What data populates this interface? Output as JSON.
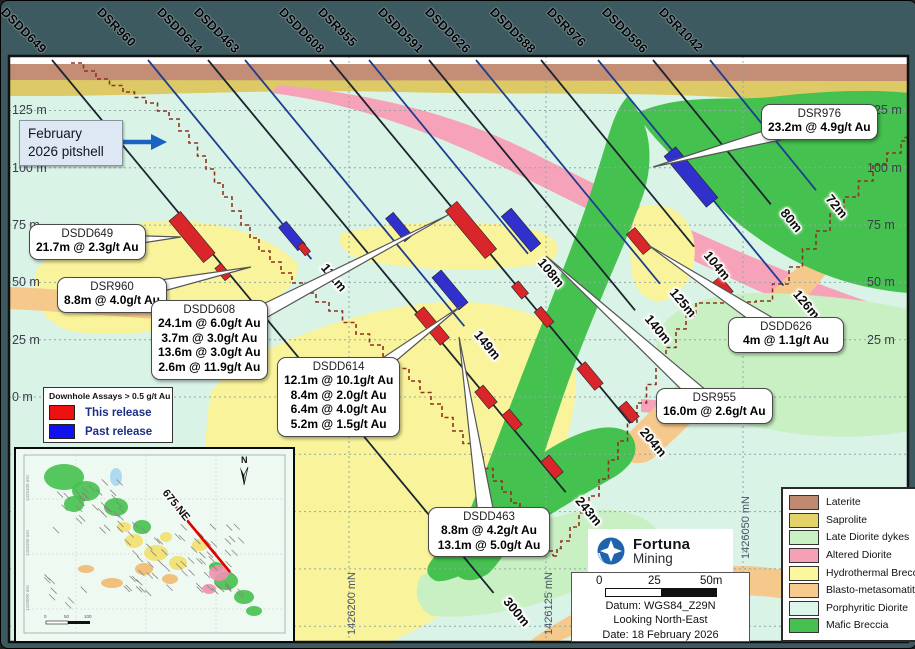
{
  "figure": {
    "pitshell_label_1": "February",
    "pitshell_label_2": "2026 pitshell",
    "logo": {
      "name": "Fortuna",
      "sub": "Mining"
    },
    "scalebar": {
      "t0": "0",
      "t25": "25",
      "t50": "50m"
    },
    "info": {
      "datum": "Datum: WGS84_Z29N",
      "looking": "Looking North-East",
      "date": "Date: 18 February 2026"
    },
    "inset": {
      "section_label": "675 NE",
      "north_label": "N",
      "axis_labels": [
        "1426400 mN",
        "1426200 mN",
        "1426000 mN"
      ]
    }
  },
  "axes": {
    "elev_left": [
      {
        "label": "125 m",
        "y": 109
      },
      {
        "label": "100 m",
        "y": 167
      },
      {
        "label": "75 m",
        "y": 224
      },
      {
        "label": "50 m",
        "y": 281
      },
      {
        "label": "25 m",
        "y": 339
      },
      {
        "label": "0 m",
        "y": 396
      }
    ],
    "elev_right": [
      {
        "label": "125 m",
        "y": 109
      },
      {
        "label": "100 m",
        "y": 167
      },
      {
        "label": "75 m",
        "y": 224
      },
      {
        "label": "50 m",
        "y": 281
      },
      {
        "label": "25 m",
        "y": 339
      }
    ],
    "grid_y": [
      109.5,
      166.8,
      224.1,
      281.4,
      338.7,
      396,
      453.3,
      510.6,
      567.9,
      625.2
    ],
    "northings": [
      {
        "label": "1426200 mN",
        "x": 348
      },
      {
        "label": "1426125 mN",
        "x": 545,
        "ytop": 560
      },
      {
        "label": "1426050 mN",
        "x": 742,
        "yb": 558
      }
    ]
  },
  "holes": [
    {
      "name": "DSDD649",
      "collar": 51,
      "depth": 300,
      "depth_label": "300m"
    },
    {
      "name": "DSR960",
      "collar": 147,
      "depth": 111,
      "depth_label": "111m"
    },
    {
      "name": "DSDD614",
      "collar": 207,
      "depth": 243,
      "depth_label": "243m"
    },
    {
      "name": "DSDD463",
      "collar": 244,
      "depth": 149,
      "depth_label": "149m"
    },
    {
      "name": "DSDD608",
      "collar": 329,
      "depth": 204,
      "depth_label": "204m"
    },
    {
      "name": "DSR955",
      "collar": 368,
      "depth": 108,
      "depth_label": "108m"
    },
    {
      "name": "DSDD591",
      "collar": 428,
      "depth": 140,
      "depth_label": "140m"
    },
    {
      "name": "DSDD626",
      "collar": 475,
      "depth": 125,
      "depth_label": "125m"
    },
    {
      "name": "DSDD588",
      "collar": 540,
      "depth": 104,
      "depth_label": "104m"
    },
    {
      "name": "DSR976",
      "collar": 597,
      "depth": 126,
      "depth_label": "126m"
    },
    {
      "name": "DSDD596",
      "collar": 652,
      "depth": 80,
      "depth_label": "80m"
    },
    {
      "name": "DSR1042",
      "collar": 709,
      "depth": 72,
      "depth_label": "72m"
    }
  ],
  "intervals": [
    {
      "x": 191,
      "y": 236,
      "len": 54,
      "w": 15,
      "c": "this"
    },
    {
      "x": 222,
      "y": 271,
      "len": 16,
      "w": 8,
      "c": "this"
    },
    {
      "x": 291,
      "y": 235,
      "len": 30,
      "w": 10,
      "c": "past"
    },
    {
      "x": 303,
      "y": 248,
      "len": 12,
      "w": 7,
      "c": "this"
    },
    {
      "x": 398,
      "y": 226,
      "len": 30,
      "w": 10,
      "c": "past"
    },
    {
      "x": 470,
      "y": 229,
      "len": 62,
      "w": 15,
      "c": "this"
    },
    {
      "x": 520,
      "y": 229,
      "len": 46,
      "w": 13,
      "c": "past"
    },
    {
      "x": 449,
      "y": 289,
      "len": 42,
      "w": 12,
      "c": "past"
    },
    {
      "x": 431,
      "y": 325,
      "len": 40,
      "w": 12,
      "c": "this"
    },
    {
      "x": 519,
      "y": 289,
      "len": 16,
      "w": 9,
      "c": "this"
    },
    {
      "x": 543,
      "y": 316,
      "len": 20,
      "w": 9,
      "c": "this"
    },
    {
      "x": 589,
      "y": 375,
      "len": 28,
      "w": 11,
      "c": "this"
    },
    {
      "x": 628,
      "y": 411,
      "len": 20,
      "w": 10,
      "c": "this"
    },
    {
      "x": 485,
      "y": 396,
      "len": 22,
      "w": 11,
      "c": "this"
    },
    {
      "x": 511,
      "y": 419,
      "len": 20,
      "w": 10,
      "c": "this"
    },
    {
      "x": 551,
      "y": 466,
      "len": 22,
      "w": 11,
      "c": "this"
    },
    {
      "x": 638,
      "y": 240,
      "len": 26,
      "w": 11,
      "c": "this"
    },
    {
      "x": 690,
      "y": 176,
      "len": 66,
      "w": 15,
      "c": "past"
    },
    {
      "x": 722,
      "y": 286,
      "len": 20,
      "w": 10,
      "c": "this"
    }
  ],
  "callouts": [
    {
      "id": "dsdd649",
      "title": "DSDD649",
      "lines": [
        "21.7m @ 2.3g/t Au"
      ],
      "x": 28,
      "y": 223,
      "w": 110,
      "h": 38,
      "tip": [
        180,
        236
      ]
    },
    {
      "id": "dsr960",
      "title": "DSR960",
      "lines": [
        "8.8m @ 4.0g/t Au"
      ],
      "x": 56,
      "y": 276,
      "w": 110,
      "h": 38,
      "tip": [
        250,
        266
      ]
    },
    {
      "id": "dsdd608",
      "title": "DSDD608",
      "lines": [
        "24.1m @ 6.0g/t Au",
        "3.7m @ 3.0g/t Au",
        "13.6m @ 3.0g/t Au",
        "2.6m @ 11.9g/t Au"
      ],
      "x": 150,
      "y": 299,
      "w": 108,
      "h": 84,
      "tip": [
        447,
        214
      ]
    },
    {
      "id": "dsdd614",
      "title": "DSDD614",
      "lines": [
        "12.1m @ 10.1g/t Au",
        "8.4m @ 2.0g/t Au",
        "6.4m @ 4.0g/t Au",
        "5.2m @ 1.5g/t Au"
      ],
      "x": 276,
      "y": 356,
      "w": 120,
      "h": 84,
      "tip": [
        460,
        305
      ]
    },
    {
      "id": "dsdd463",
      "title": "DSDD463",
      "lines": [
        "8.8m @ 4.2g/t Au",
        "13.1m @ 5.0g/t Au"
      ],
      "x": 427,
      "y": 506,
      "w": 122,
      "h": 54,
      "tip": [
        458,
        336
      ]
    },
    {
      "id": "dsr976",
      "title": "DSR976",
      "lines": [
        "23.2m @ 4.9g/t Au"
      ],
      "x": 760,
      "y": 103,
      "w": 112,
      "h": 38,
      "tip": [
        652,
        166
      ]
    },
    {
      "id": "dsdd626",
      "title": "DSDD626",
      "lines": [
        "4m @ 1.1g/t Au"
      ],
      "x": 727,
      "y": 316,
      "w": 116,
      "h": 38,
      "tip": [
        647,
        244
      ]
    },
    {
      "id": "dsr955",
      "title": "DSR955",
      "lines": [
        "16.0m @ 2.6g/t Au"
      ],
      "x": 655,
      "y": 387,
      "w": 112,
      "h": 38,
      "tip": [
        545,
        255
      ]
    }
  ],
  "assay_legend": {
    "title": "Downhole Assays > 0.5 g/t Au",
    "items": [
      {
        "label": "This release",
        "color": "#ee1111"
      },
      {
        "label": "Past release",
        "color": "#1111ee"
      }
    ]
  },
  "geo_legend": [
    {
      "label": "Laterite",
      "color": "#c08a72"
    },
    {
      "label": "Saprolite",
      "color": "#e3d169"
    },
    {
      "label": "Late Diorite dykes",
      "color": "#c9f2c4"
    },
    {
      "label": "Altered Diorite",
      "color": "#f6a0b6"
    },
    {
      "label": "Hydrothermal Breccia",
      "color": "#fbf89c"
    },
    {
      "label": "Blasto-metasomatite",
      "color": "#f7ca8e"
    },
    {
      "label": "Porphyritic Diorite",
      "color": "#dcf6ec"
    },
    {
      "label": "Mafic Breccia",
      "color": "#44c14e"
    }
  ],
  "colors": {
    "surround": "#3e5a61",
    "section_bg": "#d9f3e7",
    "this_release": "#d8262b",
    "past_release": "#3030cc",
    "pitshell": "#8d3420",
    "grid": "#92a8a8",
    "trace_dark": "#1c2430",
    "trace_blue": "#1d3e8e",
    "arrow_blue": "#1b63c1"
  },
  "pitshell": {
    "left": [
      [
        70,
        62
      ],
      [
        95,
        78
      ],
      [
        122,
        91
      ],
      [
        145,
        102
      ],
      [
        168,
        118
      ],
      [
        188,
        142
      ],
      [
        205,
        168
      ],
      [
        222,
        196
      ],
      [
        240,
        224
      ],
      [
        258,
        250
      ],
      [
        280,
        272
      ],
      [
        302,
        292
      ],
      [
        328,
        310
      ],
      [
        355,
        333
      ],
      [
        382,
        355
      ],
      [
        408,
        380
      ],
      [
        430,
        403
      ],
      [
        452,
        430
      ],
      [
        472,
        455
      ],
      [
        492,
        480
      ],
      [
        510,
        502
      ],
      [
        528,
        524
      ],
      [
        542,
        545
      ],
      [
        552,
        555
      ]
    ],
    "right": [
      [
        552,
        555
      ],
      [
        560,
        540
      ],
      [
        578,
        512
      ],
      [
        598,
        478
      ],
      [
        617,
        440
      ],
      [
        636,
        402
      ],
      [
        655,
        365
      ],
      [
        675,
        328
      ],
      [
        695,
        302
      ],
      [
        755,
        300
      ],
      [
        788,
        266
      ],
      [
        815,
        230
      ],
      [
        843,
        196
      ],
      [
        872,
        164
      ],
      [
        900,
        140
      ],
      [
        907,
        133
      ]
    ]
  },
  "geology": [
    {
      "unit": "saprolite",
      "color": "#ddca66",
      "d": "M8,78 L907,78 L907,112 C840,110 780,98 700,95 C600,91 520,94 400,91 C280,88 160,94 60,95 L8,95 Z"
    },
    {
      "unit": "laterite",
      "color": "#c38d76",
      "d": "M8,62 L907,62 L907,80 L8,79 Z"
    },
    {
      "unit": "surface_cap",
      "color": "#ffffff",
      "d": "M8,55 L907,55 L907,63 L8,63 Z"
    },
    {
      "unit": "altered_diorite",
      "color": "#f6a3b9",
      "d": "M278,84 C360,92 440,108 520,146 C600,186 680,228 790,272 C840,292 880,305 907,315 L907,345 C860,330 800,310 740,282 C660,245 580,205 500,165 C420,126 340,100 270,92 Z"
    },
    {
      "unit": "altered_diorite",
      "color": "#f6a3b9",
      "d": "M640,398 C720,404 800,408 907,400 L907,412 C800,421 720,417 640,411 Z"
    },
    {
      "unit": "altered_diorite",
      "color": "#f6a3b9",
      "d": "M595,545 C630,538 672,548 702,563 C682,579 640,583 610,575 C595,568 588,555 595,545 Z"
    },
    {
      "unit": "hydrothermal_breccia",
      "color": "#f9f49b",
      "d": "M36,268 C60,238 110,222 160,220 C220,218 270,235 296,262 C300,285 275,300 240,312 C190,328 120,338 70,330 C40,322 28,295 36,268 Z"
    },
    {
      "unit": "hydrothermal_breccia",
      "color": "#f9f49b",
      "d": "M340,232 C400,220 470,216 530,228 C560,235 565,252 545,262 C490,272 420,270 365,260 C342,254 335,242 340,232 Z"
    },
    {
      "unit": "hydrothermal_breccia",
      "color": "#f9f49b",
      "d": "M210,390 C240,355 300,330 370,312 C440,295 500,298 540,318 C570,335 580,370 572,410 C565,455 545,505 515,545 C485,585 440,620 390,640 L240,640 C215,620 200,560 202,500 C203,460 205,420 210,390 Z"
    },
    {
      "unit": "hydrothermal_breccia",
      "color": "#f9f49b",
      "d": "M640,205 C665,200 685,210 692,235 C698,262 688,288 668,298 C648,305 632,292 630,265 C628,240 630,215 640,205 Z"
    },
    {
      "unit": "blasto_metasomatite",
      "color": "#f5c98c",
      "d": "M8,286 C70,288 150,297 230,308 L230,324 C150,318 70,311 8,308 Z"
    },
    {
      "unit": "blasto_metasomatite",
      "color": "#f5c98c",
      "d": "M612,448 C660,400 720,340 790,272 L815,252 L832,264 C780,330 715,400 655,455 C640,468 622,462 612,448 Z"
    },
    {
      "unit": "blasto_metasomatite",
      "color": "#f5c98c",
      "d": "M520,647 C560,615 620,585 690,570 C740,560 790,565 830,585 L830,610 C780,592 730,590 680,602 C620,616 570,632 545,647 Z"
    },
    {
      "unit": "late_diorite_dykes",
      "color": "#c9f0c3",
      "d": "M655,340 C660,310 700,292 760,292 C820,293 870,300 907,308 L907,430 C850,441 780,436 720,416 C682,402 660,372 655,340 Z"
    },
    {
      "unit": "late_diorite_dykes",
      "color": "#c9f0c3",
      "d": "M420,575 C470,545 530,520 580,510 C620,505 650,515 660,535 C640,560 600,580 560,595 C520,610 470,618 430,615 C415,605 412,590 420,575 Z"
    },
    {
      "unit": "mafic_breccia",
      "color": "#44c14e",
      "d": "M636,112 C680,92 730,100 770,96 C820,90 870,88 907,92 L907,292 C860,288 820,275 785,255 C745,232 715,205 690,175 C665,148 645,130 636,112 Z"
    },
    {
      "unit": "mafic_breccia",
      "color": "#44c14e",
      "d": "M626,96 C650,120 655,160 640,200 C622,248 598,300 578,352 C560,398 545,448 530,492 C518,528 505,555 488,572 C470,585 452,580 450,560 C460,530 475,495 490,455 C508,408 528,355 548,305 C566,258 585,210 598,165 C608,135 612,112 626,96 Z"
    },
    {
      "unit": "mafic_breccia",
      "color": "#44c14e",
      "d": "M430,560 C460,520 500,480 545,450 C580,428 610,420 628,432 C640,445 635,462 615,475 C575,498 535,520 500,548 C475,568 450,582 435,580 C425,575 424,568 430,560 Z"
    }
  ]
}
